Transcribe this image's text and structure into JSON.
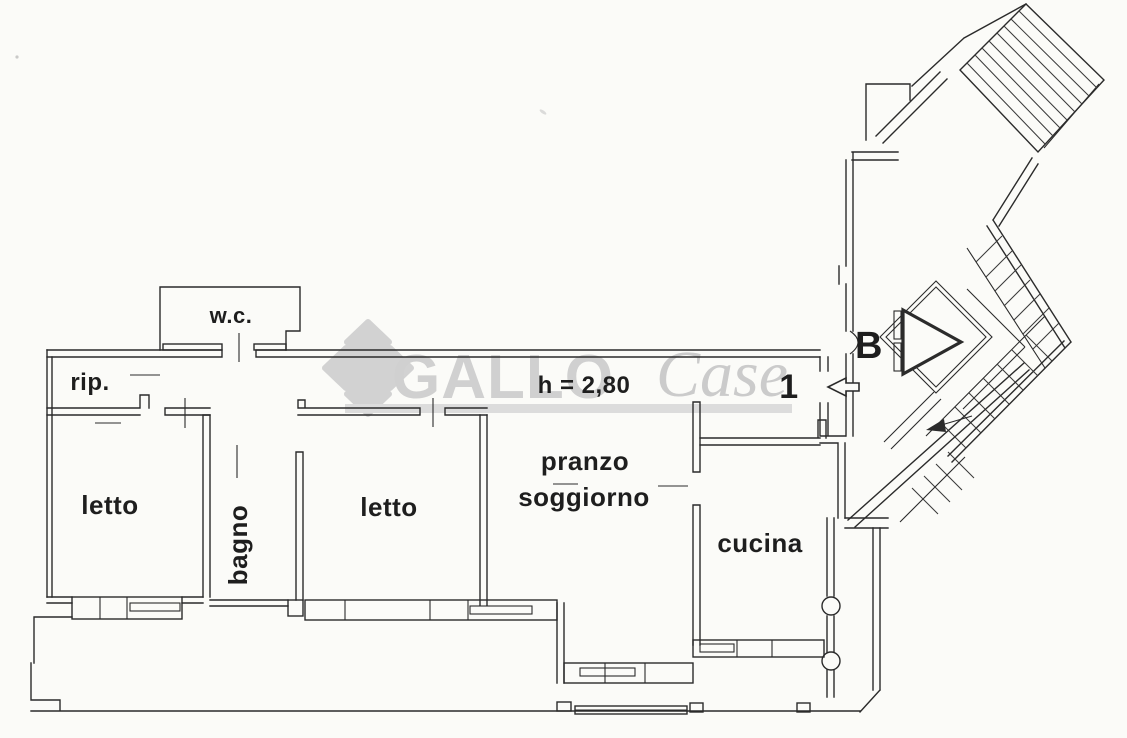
{
  "document": {
    "kind": "apartment floor plan scan",
    "language": "it"
  },
  "colors": {
    "paper": "#fbfbf8",
    "ink": "#2b2b2b",
    "watermark_gray": "#d2d2d2",
    "watermark_band": "#dcdcdc"
  },
  "watermark": {
    "brand_bold": "GALLO",
    "brand_script": "Case",
    "logo_icon": "diamond-clover-logo"
  },
  "labels": {
    "wc": "w.c.",
    "storage": "rip.",
    "bedroom_left": "letto",
    "bathroom": "bagno",
    "bedroom_mid": "letto",
    "dining_line1": "pranzo",
    "dining_line2": "soggiorno",
    "kitchen": "cucina",
    "height_note": "h = 2,80",
    "unit_number": "1",
    "stair_block": "B"
  }
}
